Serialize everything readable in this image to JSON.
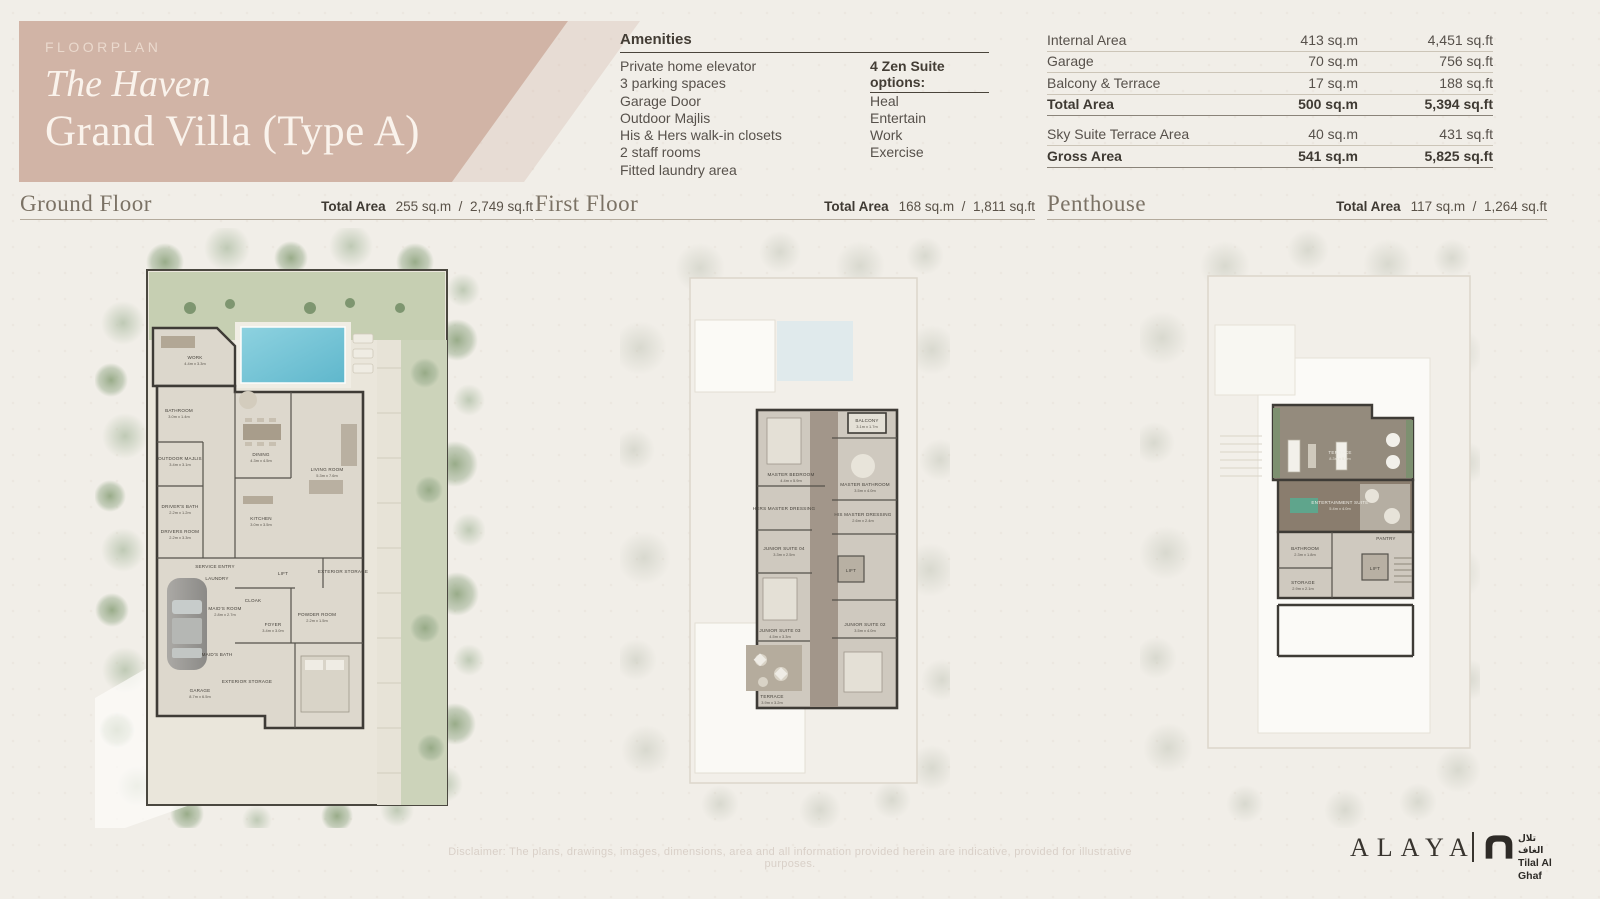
{
  "header": {
    "eyebrow": "FLOORPLAN",
    "title_line1": "The Haven",
    "title_line2": "Grand Villa (Type A)"
  },
  "amenities": {
    "heading": "Amenities",
    "items": [
      "Private home elevator",
      "3 parking spaces",
      "Garage Door",
      "Outdoor Majlis",
      "His & Hers walk-in closets",
      "2 staff rooms",
      "Fitted laundry area"
    ],
    "zen_heading": "4 Zen Suite options:",
    "zen_items": [
      "Heal",
      "Entertain",
      "Work",
      "Exercise"
    ]
  },
  "area_table": {
    "rows": [
      {
        "label": "Internal Area",
        "sqm": "413 sq.m",
        "sqft": "4,451 sq.ft"
      },
      {
        "label": "Garage",
        "sqm": "70 sq.m",
        "sqft": "756 sq.ft"
      },
      {
        "label": "Balcony & Terrace",
        "sqm": "17 sq.m",
        "sqft": "188 sq.ft"
      },
      {
        "label": "Total Area",
        "sqm": "500 sq.m",
        "sqft": "5,394 sq.ft"
      },
      {
        "label": "Sky Suite Terrace Area",
        "sqm": "40 sq.m",
        "sqft": "431 sq.ft"
      },
      {
        "label": "Gross Area",
        "sqm": "541 sq.m",
        "sqft": "5,825 sq.ft"
      }
    ]
  },
  "floors": [
    {
      "name": "Ground Floor",
      "total_label": "Total Area",
      "sqm": "255 sq.m",
      "divider": "/",
      "sqft": "2,749 sq.ft",
      "rooms": [
        {
          "name": "WORK",
          "dims": "4.4m x 3.3m"
        },
        {
          "name": "BATHROOM",
          "dims": "3.0m x 1.4m"
        },
        {
          "name": "OUTDOOR MAJLIS",
          "dims": "3.4m x 3.1m"
        },
        {
          "name": "DINING",
          "dims": "4.3m x 4.5m"
        },
        {
          "name": "LIVING ROOM",
          "dims": "5.3m x 7.6m"
        },
        {
          "name": "KITCHEN",
          "dims": "3.0m x 3.5m"
        },
        {
          "name": "DRIVER'S BATH",
          "dims": "2.2m x 1.2m"
        },
        {
          "name": "DRIVERS ROOM",
          "dims": "2.2m x 3.3m"
        },
        {
          "name": "SERVICE ENTRY",
          "dims": ""
        },
        {
          "name": "LAUNDRY",
          "dims": ""
        },
        {
          "name": "MAID'S ROOM",
          "dims": "2.8m x 2.7m"
        },
        {
          "name": "MAID'S BATH",
          "dims": ""
        },
        {
          "name": "FOYER",
          "dims": "3.4m x 3.0m"
        },
        {
          "name": "CLOAK",
          "dims": ""
        },
        {
          "name": "POWDER ROOM",
          "dims": "2.2m x 1.5m"
        },
        {
          "name": "LIFT",
          "dims": ""
        },
        {
          "name": "EXTERIOR STORAGE",
          "dims": ""
        },
        {
          "name": "EXTERIOR STORAGE",
          "dims": ""
        },
        {
          "name": "GARAGE",
          "dims": "8.7m x 6.5m"
        }
      ]
    },
    {
      "name": "First Floor",
      "total_label": "Total Area",
      "sqm": "168 sq.m",
      "divider": "/",
      "sqft": "1,811 sq.ft",
      "rooms": [
        {
          "name": "BALCONY",
          "dims": "3.1m x 1.7m"
        },
        {
          "name": "MASTER BEDROOM",
          "dims": "4.4m x 5.9m"
        },
        {
          "name": "MASTER BATHROOM",
          "dims": "3.5m x 4.0m"
        },
        {
          "name": "HERS MASTER DRESSING",
          "dims": ""
        },
        {
          "name": "HIS MASTER DRESSING",
          "dims": "2.6m x 2.4m"
        },
        {
          "name": "JUNIOR SUITE 04",
          "dims": "3.3m x 2.5m"
        },
        {
          "name": "LIFT",
          "dims": ""
        },
        {
          "name": "JUNIOR SUITE 03",
          "dims": "4.5m x 3.3m"
        },
        {
          "name": "TERRACE",
          "dims": "3.9m x 3.2m"
        },
        {
          "name": "JUNIOR SUITE 02",
          "dims": "3.5m x 4.0m"
        }
      ]
    },
    {
      "name": "Penthouse",
      "total_label": "Total Area",
      "sqm": "117 sq.m",
      "divider": "/",
      "sqft": "1,264 sq.ft",
      "rooms": [
        {
          "name": "TERRACE",
          "dims": "8.3m x 5.0m"
        },
        {
          "name": "ENTERTAINMENT SUITE",
          "dims": "5.4m x 4.0m"
        },
        {
          "name": "PANTRY",
          "dims": ""
        },
        {
          "name": "BATHROOM",
          "dims": "2.3m x 1.8m"
        },
        {
          "name": "STORAGE",
          "dims": "2.9m x 2.1m"
        },
        {
          "name": "LIFT",
          "dims": ""
        }
      ]
    }
  ],
  "footer": {
    "disclaimer": "Disclaimer: The plans, drawings, images, dimensions, area and all information provided herein are indicative, provided for illustrative purposes.",
    "brand": "ALAYA",
    "partner_ar": "تلال الغاف",
    "partner_en": "Tilal Al Ghaf"
  },
  "colors": {
    "band": "#d1b4a6",
    "background": "#f1eee8",
    "pool": "#7fc9da",
    "wall": "#3e3b36",
    "lawn": "#c6cfb2",
    "heading_text": "#7b7265"
  }
}
